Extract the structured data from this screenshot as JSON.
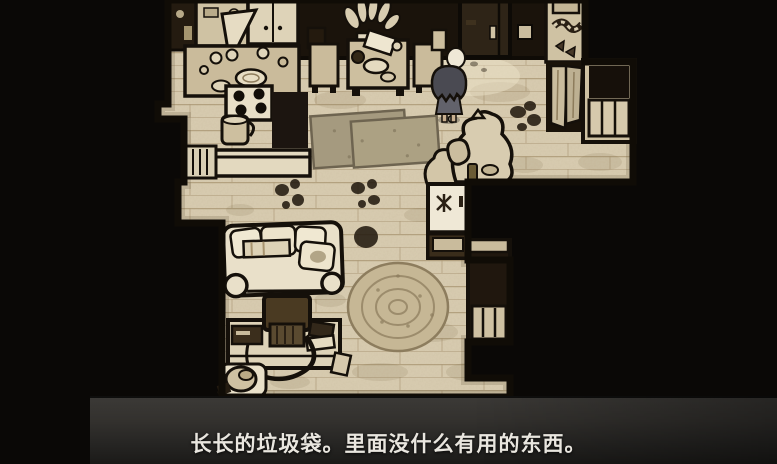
{
  "subtitle": {
    "text": "长长的垃圾袋。里面没什么有用的东西。"
  },
  "scene": {
    "description": "top-down hand-drawn apartment interior",
    "objects": [
      "kitchen-cabinets",
      "open-cabinet-door",
      "kitchen-counter",
      "stove",
      "kettle",
      "radiator",
      "counter-bar",
      "dining-table",
      "dining-chair-left",
      "dining-chair-right",
      "potted-plant",
      "entry-door",
      "wall-picture",
      "storage-shelf",
      "hanging-coats",
      "window-radiator",
      "floor-mat",
      "trash-bags",
      "floor-stains",
      "player-character",
      "refrigerator",
      "side-cabinet",
      "sofa",
      "tv",
      "tv-desk",
      "vcr",
      "books",
      "vacuum-cleaner",
      "round-rug"
    ],
    "colors": {
      "background": "#0a0806",
      "ink_outline": "#15100a",
      "wall_dark": "#1a130b",
      "floor": "#d9cdb2",
      "plank_line": "#a8946f",
      "furniture_tan": "#cdbf9f",
      "light_item": "#ece3cb",
      "door_brown": "#2e2417",
      "mat_gray": "#a69b80",
      "round_rug": "#c6b795",
      "fridge_white": "#efe8d6",
      "hair": "#4a4a52",
      "dress": "#62626b",
      "skin": "#c9b090",
      "subtitle_bar": "#2b2a28",
      "subtitle_text": "#e9e6df"
    }
  }
}
